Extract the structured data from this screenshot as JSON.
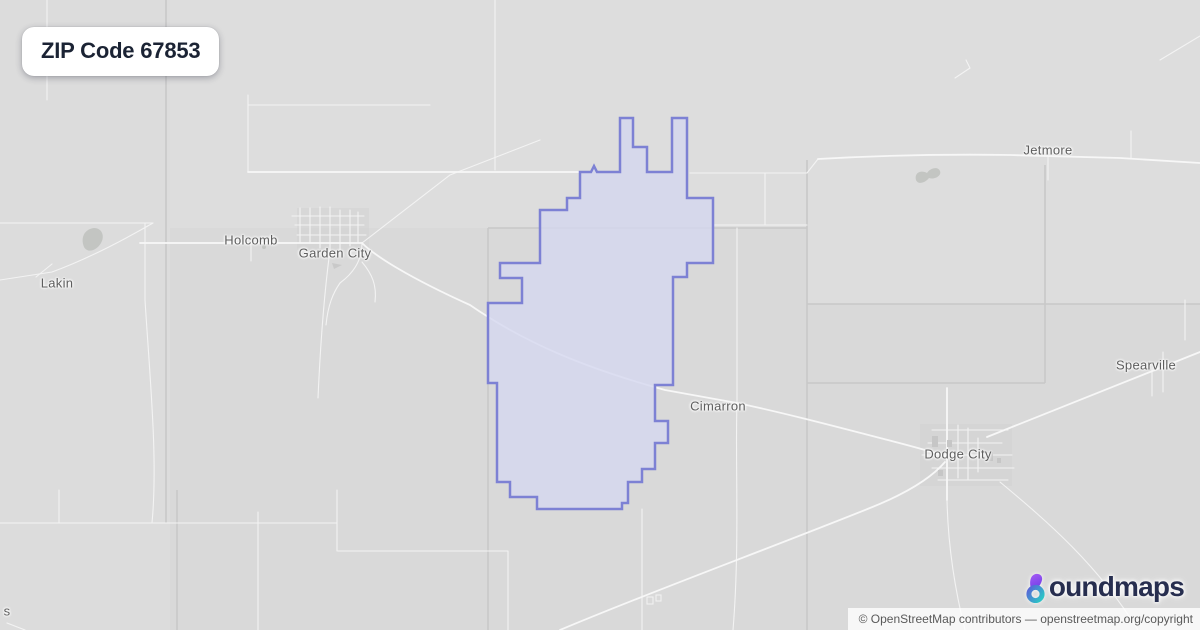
{
  "badge": {
    "title": "ZIP Code 67853"
  },
  "map": {
    "labels": [
      {
        "id": "lakin",
        "text": "Lakin",
        "x": 57,
        "y": 283
      },
      {
        "id": "holcomb",
        "text": "Holcomb",
        "x": 251,
        "y": 240
      },
      {
        "id": "garden-city",
        "text": "Garden City",
        "x": 335,
        "y": 253
      },
      {
        "id": "jetmore",
        "text": "Jetmore",
        "x": 1048,
        "y": 150
      },
      {
        "id": "cimarron",
        "text": "Cimarron",
        "x": 718,
        "y": 406
      },
      {
        "id": "dodge-city",
        "text": "Dodge City",
        "x": 958,
        "y": 454
      },
      {
        "id": "spearville",
        "text": "Spearville",
        "x": 1146,
        "y": 365
      },
      {
        "id": "edge-partial",
        "text": "s",
        "x": 7,
        "y": 611
      }
    ],
    "region": {
      "zip": "67853",
      "outline_points": "620,118 633,118 633,147 647,147 647,172 672,172 672,118 687,118 687,198 713,198 713,263 687,263 687,277 673,277 673,385 655,385 655,421 668,421 668,443 655,443 655,469 642,469 642,482 628,482 628,503 622,503 622,509 537,509 537,497 510,497 510,482 497,482 497,383 488,383 488,303 522,303 522,278 500,278 500,263 540,263 540,210 567,210 567,198 580,198 580,172 591,172 594,166 597,172 620,172",
      "stroke_color": "#7d81d4",
      "fill_color": "#d5d7ef"
    }
  },
  "logo": {
    "brand": "boundmaps",
    "wordmark_text": "oundmaps",
    "text_color": "#272e4f",
    "glyph_gradient": {
      "stem_top": "#a75cf4",
      "stem_bottom": "#7440e8",
      "ring_start": "#5a63d8",
      "ring_end": "#2cc3c6"
    }
  },
  "attribution": {
    "prefix": "© OpenStreetMap contributors",
    "separator": "—",
    "link_text": "openstreetmap.org/copyright"
  }
}
